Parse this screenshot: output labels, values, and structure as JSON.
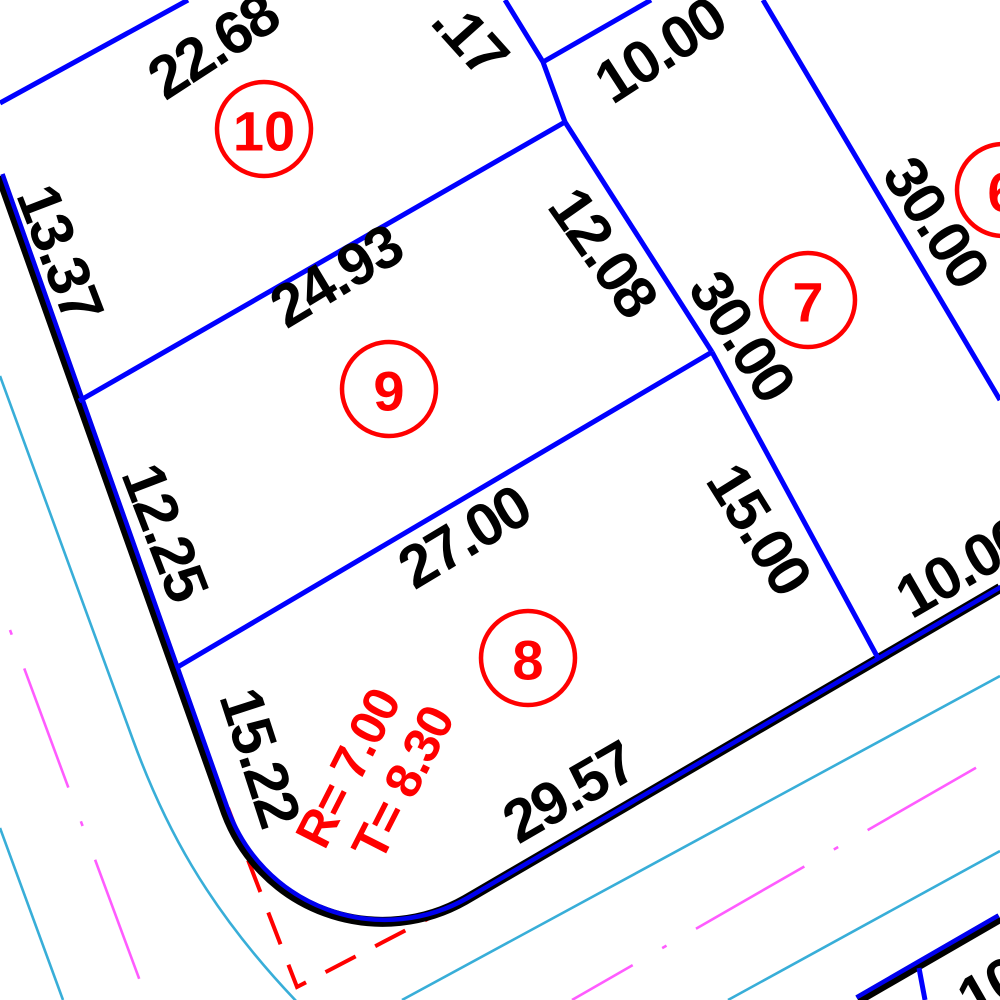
{
  "drawing": {
    "background": "#ffffff",
    "colors": {
      "lot_line": "#0000ff",
      "street_black": "#000000",
      "street_blue": "#0000f0",
      "curb": "#38aed8",
      "centerline": "#ff5cff",
      "red": "#ff0000",
      "text": "#000000"
    },
    "street_edges": [
      {
        "name": "street-edge-west-to-south",
        "d": "M 0 176 L 226 813 A 167 167 0 0 0 465 900 L 1000 588",
        "black_width": 10,
        "blue_width": 4.5,
        "blue_dx": 2.5,
        "blue_dy": -2
      },
      {
        "name": "street-edge-southeast",
        "d": "M 858 1000 L 1000 918",
        "black_width": 10,
        "blue_width": 4.5,
        "blue_dx": -1.5,
        "blue_dy": -2.6
      }
    ],
    "curb_lines": [
      {
        "name": "curb-line-west",
        "d": "M 0 376 L 133 740 C 163 822 205 906 298 1003"
      },
      {
        "name": "curb-line-southwest",
        "d": "M 0 828 L 63 1000"
      },
      {
        "name": "curb-line-south",
        "d": "M 402 1000 L 1000 676"
      },
      {
        "name": "curb-line-southeast",
        "d": "M 728 1000 L 1000 851"
      }
    ],
    "centerlines": [
      {
        "name": "road-centerline-west",
        "d": "M 10 630 L 150 1008",
        "dash": "127 36 5 36",
        "dashoffset": "163"
      },
      {
        "name": "road-centerline-south",
        "d": "M 572 1000 L 1000 754",
        "dash": "125 34 5 34",
        "dashoffset": "55"
      }
    ],
    "lot_lines": [
      {
        "name": "lot10-north-line",
        "d": "M 0 103 L 188 0"
      },
      {
        "name": "lot10-lot9-line",
        "d": "M 79 401 L 565 122"
      },
      {
        "name": "rear-lot-line-north",
        "d": "M 505 0 L 543 62 L 565 122"
      },
      {
        "name": "rear-lot-line-branch",
        "d": "M 543 62 L 651 0"
      },
      {
        "name": "lot7-west-line",
        "d": "M 565 122 L 712 352"
      },
      {
        "name": "lot9-lot8-line",
        "d": "M 176 668 L 712 352"
      },
      {
        "name": "lot8-lot7-line",
        "d": "M 712 352 L 878 658"
      },
      {
        "name": "lot7-lot6-line",
        "d": "M 763 0 L 1000 400"
      },
      {
        "name": "lot-line-tick-southeast",
        "d": "M 919 968 L 925 1000"
      }
    ],
    "curve_tangent": {
      "name": "corner-curve-tangent",
      "d": "M 228 808 L 297 987 L 458 903",
      "dash": "34 22",
      "width": 4
    },
    "dimensions": [
      {
        "text": "22.68",
        "x": 213,
        "y": 46,
        "rot": -33
      },
      {
        "text": ".17",
        "x": 470,
        "y": 38,
        "rot": 48
      },
      {
        "text": "10.00",
        "x": 660,
        "y": 50,
        "rot": -33
      },
      {
        "text": "24.93",
        "x": 336,
        "y": 276,
        "rot": -31
      },
      {
        "text": "12.08",
        "x": 603,
        "y": 252,
        "rot": 55
      },
      {
        "text": "30.00",
        "x": 742,
        "y": 336,
        "rot": 57
      },
      {
        "text": "30.00",
        "x": 936,
        "y": 222,
        "rot": 57
      },
      {
        "text": "13.37",
        "x": 60,
        "y": 253,
        "rot": 69
      },
      {
        "text": "12.25",
        "x": 165,
        "y": 532,
        "rot": 69
      },
      {
        "text": "27.00",
        "x": 464,
        "y": 537,
        "rot": -31
      },
      {
        "text": "15.00",
        "x": 759,
        "y": 529,
        "rot": 58
      },
      {
        "text": "15.22",
        "x": 260,
        "y": 757,
        "rot": 72
      },
      {
        "text": "29.57",
        "x": 569,
        "y": 792,
        "rot": -30
      },
      {
        "text": "10.00",
        "x": 962,
        "y": 567,
        "rot": -30
      },
      {
        "text": "10",
        "x": 990,
        "y": 988,
        "rot": -30
      }
    ],
    "curve_labels": [
      {
        "text": "R= 7.00",
        "x": 348,
        "y": 768,
        "rot": -63
      },
      {
        "text": "T= 8.30",
        "x": 403,
        "y": 783,
        "rot": -63
      }
    ],
    "lot_markers": [
      {
        "number": "10",
        "cx": 264,
        "cy": 129,
        "r": 47
      },
      {
        "number": "9",
        "cx": 389,
        "cy": 389,
        "r": 47
      },
      {
        "number": "8",
        "cx": 528,
        "cy": 658,
        "r": 47
      },
      {
        "number": "7",
        "cx": 808,
        "cy": 300,
        "r": 47
      },
      {
        "number": "6",
        "cx": 1003,
        "cy": 190,
        "r": 46
      }
    ]
  }
}
